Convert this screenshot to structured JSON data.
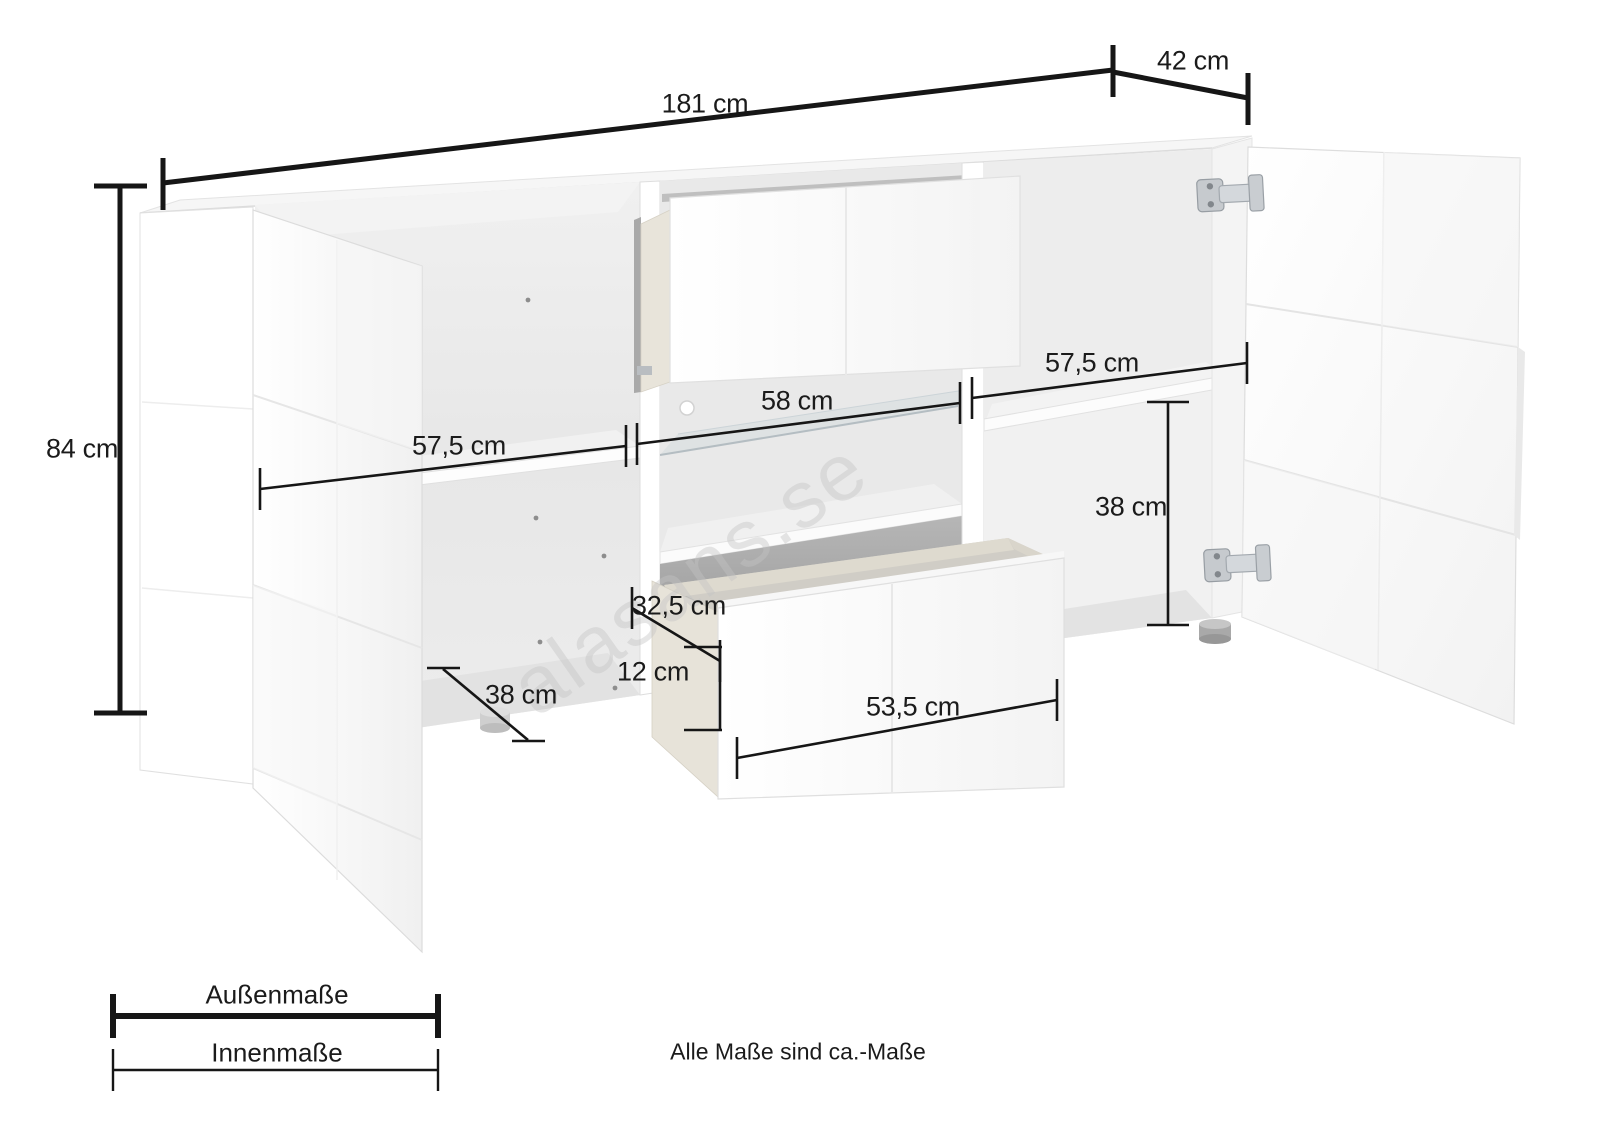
{
  "watermark": "alasans.se",
  "note": "Alle Maße sind ca.-Maße",
  "legend": {
    "outer_label": "Außenmaße",
    "inner_label": "Innenmaße"
  },
  "dims": {
    "total_width": "181 cm",
    "total_depth": "42 cm",
    "total_height": "84 cm",
    "left_compartment_width": "57,5 cm",
    "middle_compartment_width": "58 cm",
    "right_compartment_width": "57,5 cm",
    "right_compartment_height": "38 cm",
    "drawer_depth": "32,5 cm",
    "drawer_inner_height": "12 cm",
    "compartment_depth": "38 cm",
    "drawer_width": "53,5 cm"
  },
  "colors": {
    "dimension_line": "#161616",
    "watermark": "#c4c4c4"
  }
}
